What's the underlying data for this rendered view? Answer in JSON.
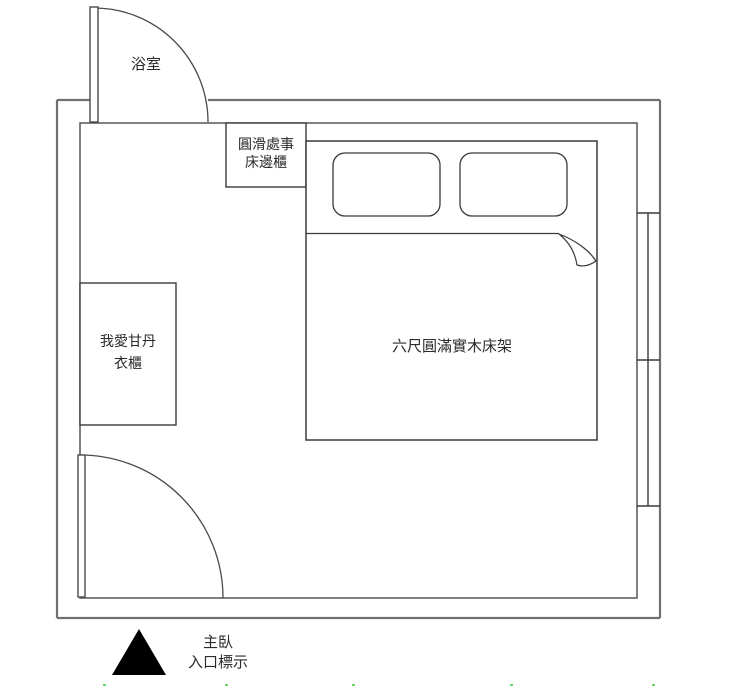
{
  "labels": {
    "bathroom": "浴室",
    "bedside_cabinet": {
      "line1": "圓滑處事",
      "line2": "床邊櫃"
    },
    "wardrobe": {
      "line1": "我愛甘丹",
      "line2": "衣櫃"
    },
    "bed": "六尺圓滿實木床架",
    "entrance": {
      "line1": "主臥",
      "line2": "入口標示"
    }
  },
  "icons": {
    "entrance_marker": "filled-triangle-up"
  },
  "colors": {
    "background": "#ffffff",
    "outer_wall": "#707070",
    "inner_wall": "#4a4a4a",
    "furniture_line": "#3a3a3a",
    "text": "#2b2b2b",
    "entrance_marker": "#000000",
    "bottom_edge_artifact": "#44cc44"
  }
}
